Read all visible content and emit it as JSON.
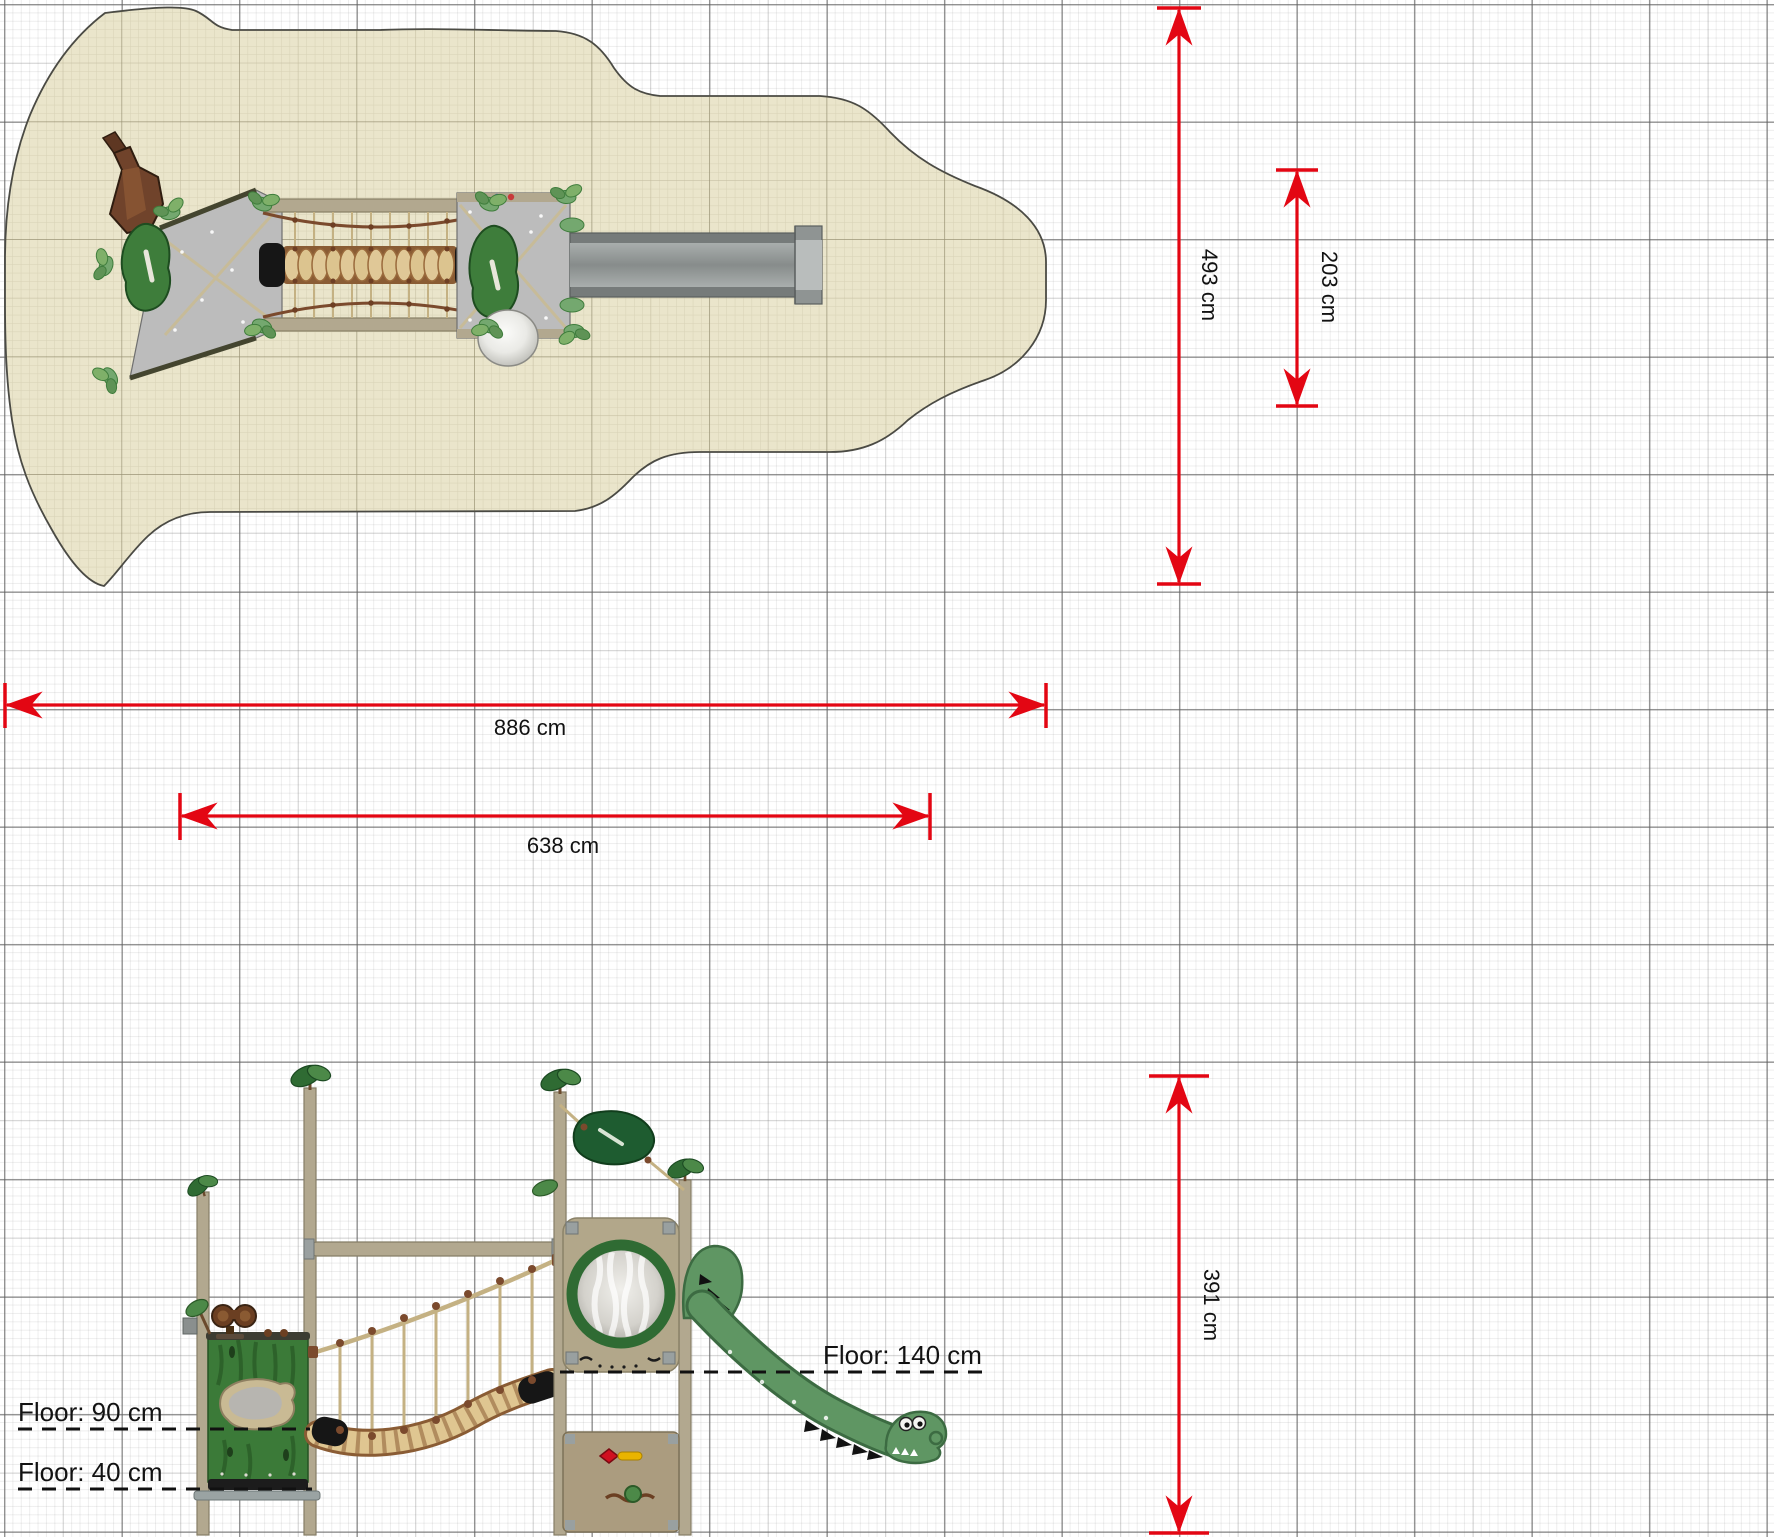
{
  "drawing": {
    "kind": "playground equipment technical drawing",
    "views": [
      "top view with safety surfacing",
      "side elevation"
    ]
  },
  "labels": {
    "d493": "493 cm",
    "d203": "203 cm",
    "d886": "886 cm",
    "d638": "638 cm",
    "d391": "391 cm",
    "floor140": "Floor: 140 cm",
    "floor90": "Floor: 90 cm",
    "floor40": "Floor: 40 cm"
  },
  "colors": {
    "dimension_red": "#e30613",
    "sand_surface": "#eae5cb",
    "pole_khaki": "#b2a88f",
    "leaf_green": "#3e7d3b",
    "dark_leaf_green": "#1e5c30",
    "slide_green": "#5f9663",
    "platform_gray": "#bcbcbc",
    "rope_tan": "#c4b183",
    "knot_brown": "#7b4a2d",
    "text": "#121212"
  }
}
